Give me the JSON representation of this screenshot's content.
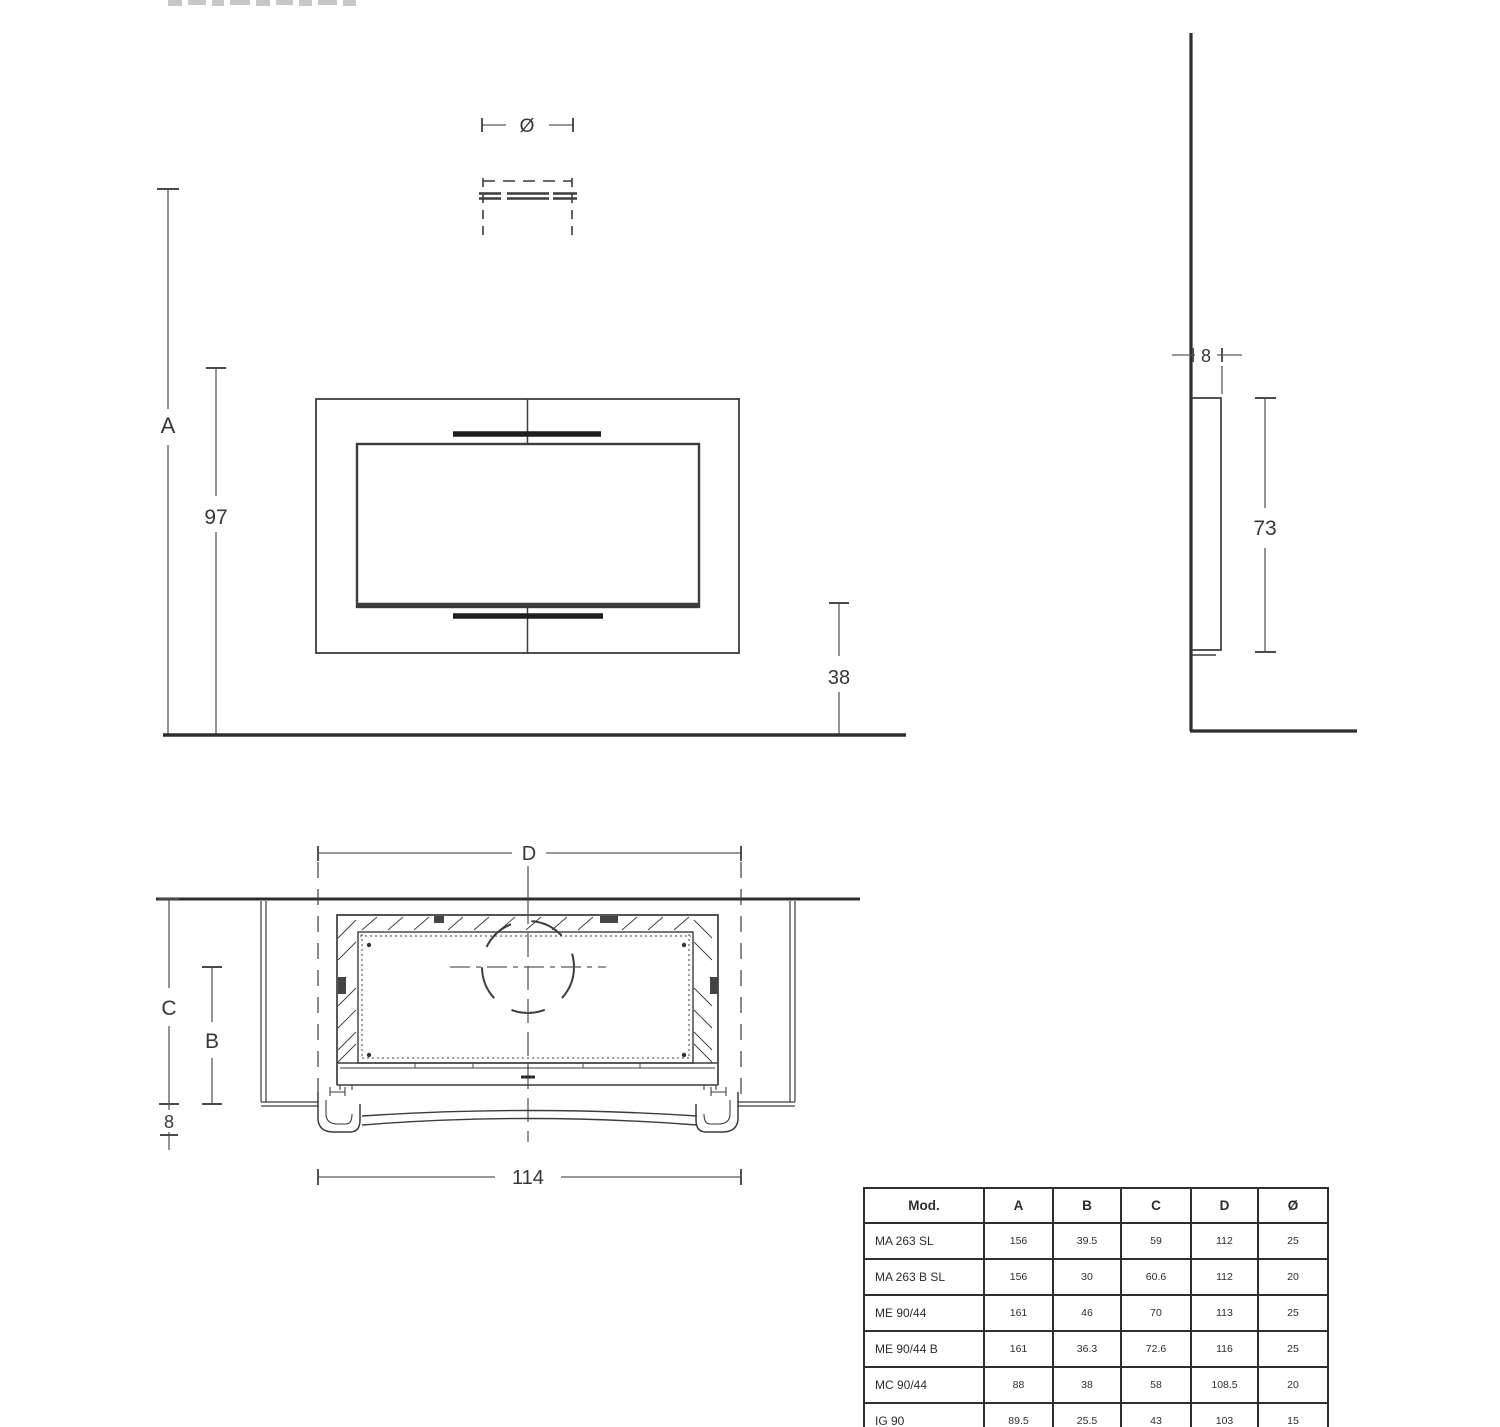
{
  "drawing": {
    "front": {
      "diameter_label": "Ø",
      "height_total_label": "A",
      "height_97_label": "97",
      "height_38_label": "38"
    },
    "side": {
      "depth_8_label": "8",
      "height_73_label": "73"
    },
    "plan": {
      "width_d_label": "D",
      "depth_c_label": "C",
      "depth_b_label": "B",
      "depth_8_label": "8",
      "width_114_label": "114"
    }
  },
  "table": {
    "headers": [
      "Mod.",
      "A",
      "B",
      "C",
      "D",
      "Ø"
    ],
    "rows": [
      [
        "MA 263 SL",
        "156",
        "39.5",
        "59",
        "112",
        "25"
      ],
      [
        "MA 263 B SL",
        "156",
        "30",
        "60.6",
        "112",
        "20"
      ],
      [
        "ME 90/44",
        "161",
        "46",
        "70",
        "113",
        "25"
      ],
      [
        "ME 90/44 B",
        "161",
        "36.3",
        "72.6",
        "116",
        "25"
      ],
      [
        "MC 90/44",
        "88",
        "38",
        "58",
        "108.5",
        "20"
      ],
      [
        "IG 90",
        "89.5",
        "25.5",
        "43",
        "103",
        "15"
      ]
    ]
  }
}
